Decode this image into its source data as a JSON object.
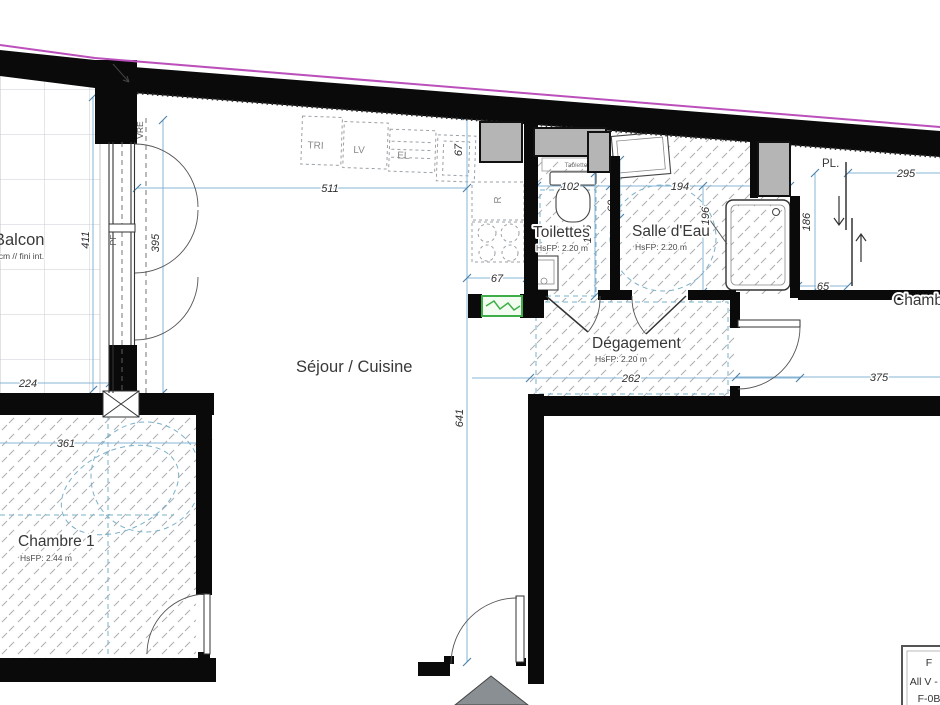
{
  "rooms": {
    "balcon": {
      "label": "Balcon",
      "note": "0cm // fini int."
    },
    "sejour": {
      "label": "Séjour / Cuisine"
    },
    "toilettes": {
      "label": "Toilettes",
      "ceiling": "HsFP: 2.20 m"
    },
    "salle_eau": {
      "label": "Salle d'Eau",
      "ceiling": "HsFP: 2.20 m"
    },
    "degagement": {
      "label": "Dégagement",
      "ceiling": "HsFP: 2.20 m"
    },
    "chambre1": {
      "label": "Chambre 1",
      "ceiling": "HsFP: 2.44 m"
    },
    "chambre2": {
      "label": "Chambre"
    },
    "placard": {
      "label": "PL."
    }
  },
  "equipment": {
    "tri": "TRI",
    "lave_vaisselle": "LV",
    "el": "EL",
    "refrigerateur": "R",
    "tablette": "Tablette"
  },
  "window_tags": {
    "pf": "PF",
    "vre": "VRE"
  },
  "dimensions": {
    "d511": "511",
    "d67_counter": "67",
    "d102": "102",
    "d194": "194",
    "d295": "295",
    "d411": "411",
    "d395": "395",
    "d224": "224",
    "d155": "155",
    "d60": "60",
    "d196": "196",
    "d186": "186",
    "d65": "65",
    "d67_hob": "67",
    "d262": "262",
    "d375": "375",
    "d361": "361",
    "d641": "641"
  },
  "title_block": {
    "row1": "F",
    "row2": "All V - N",
    "row3": "F-0B"
  },
  "colors": {
    "wall": "#0a0a0a",
    "dimension_line": "#85b4d4",
    "hatch": "#a9aeb4",
    "duct": "#b5b5b5",
    "panel_green": "#3fae49",
    "survey_magenta": "#bb4fbb"
  }
}
